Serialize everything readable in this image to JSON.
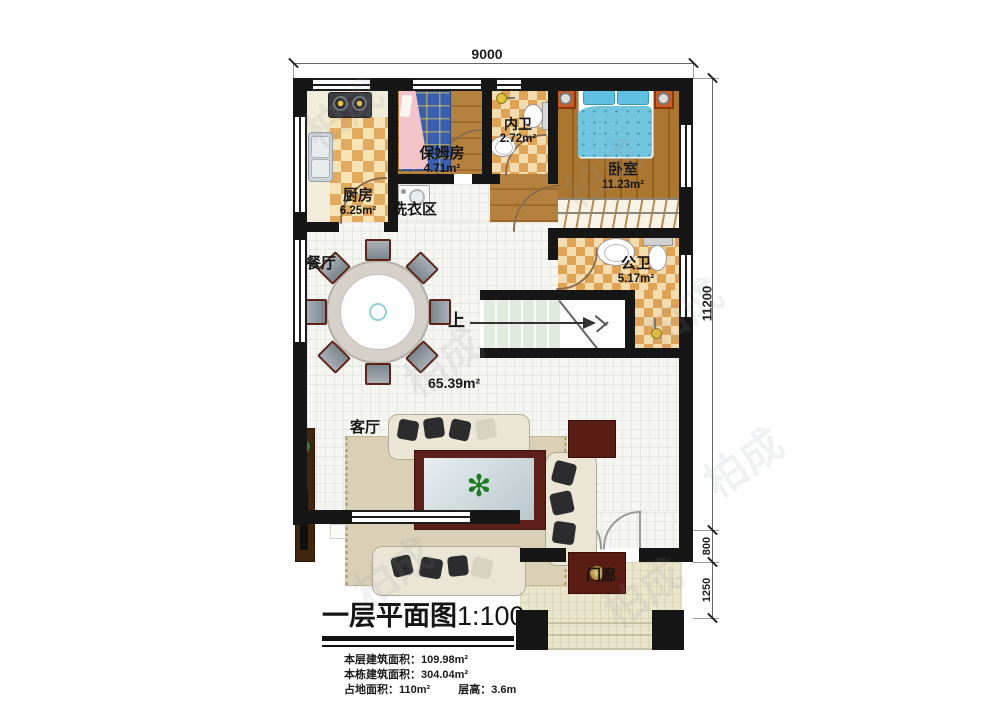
{
  "plan_title": {
    "text": "一层平面图",
    "scale": "1:100"
  },
  "stats": {
    "floor_area_label": "本层建筑面积：",
    "floor_area_value": "109.98m²",
    "building_area_label": "本栋建筑面积：",
    "building_area_value": "304.04m²",
    "footprint_label": "占地面积：",
    "footprint_value": "110m²",
    "story_height_label": "层高：",
    "story_height_value": "3.6m"
  },
  "dimensions": {
    "top_width": "9000",
    "right_height": "11200",
    "porch_offset": "800",
    "porch_depth": "1250"
  },
  "rooms": {
    "kitchen": {
      "name": "厨房",
      "area": "6.25m²"
    },
    "nanny_room": {
      "name": "保姆房",
      "area": "4.71m²"
    },
    "inner_bath": {
      "name": "内卫",
      "area": "2.72m²"
    },
    "bedroom": {
      "name": "卧室",
      "area": "11.23m²"
    },
    "laundry": {
      "name": "洗衣区"
    },
    "dining": {
      "name": "餐厅"
    },
    "public_bath": {
      "name": "公卫",
      "area": "5.17m²"
    },
    "living": {
      "name": "客厅",
      "area": "65.39m²"
    },
    "porch": {
      "name": "门廊"
    }
  },
  "stairs": {
    "direction_label": "上"
  },
  "icons": {
    "plant_glyph": "✻"
  },
  "watermark": {
    "text": "柏成"
  },
  "colors": {
    "wall": "#161616",
    "checker_dark": "#e2aa5e",
    "wood": "#b5813f",
    "bed_blue": "#72c5df",
    "accent_maroon": "#5a1d13"
  }
}
